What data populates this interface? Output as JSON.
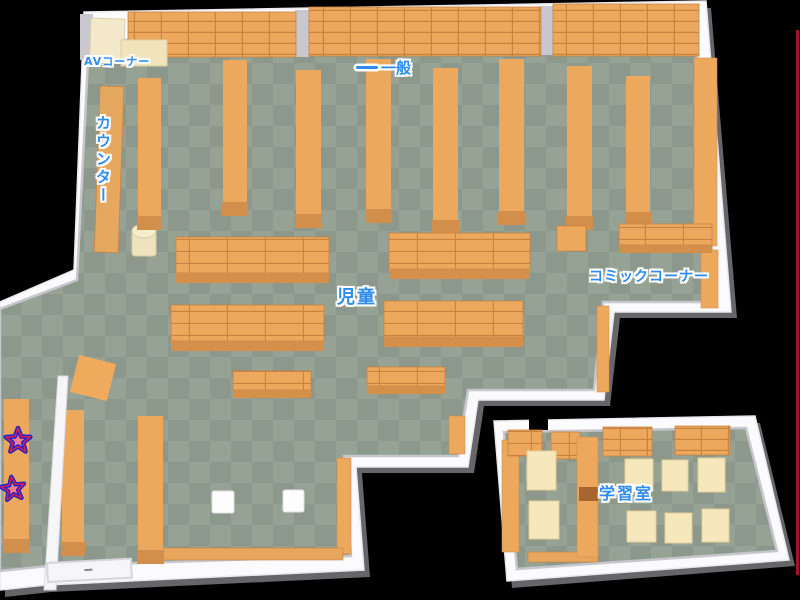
{
  "map": {
    "type": "library-floor-map",
    "areas": {
      "av_corner": "AVコーナー",
      "general": "一般",
      "counter": "カウンター",
      "children": "児童",
      "comic_corner": "コミックコーナー",
      "study_room": "学習室"
    },
    "markers": {
      "star_count": 2
    },
    "colors": {
      "background": "#000000",
      "floor_light": "#95A294",
      "floor_dark": "#8B988B",
      "wall": "#FBFBFD",
      "wall_shadow": "#C7C7CD",
      "shelf_orange": "#ECA95E",
      "shelf_line": "#C9823F",
      "shelf_front": "#D28E4B",
      "furniture_cream": "#F3E9CA",
      "table_cream": "#F6E8BC",
      "label_blue": "#2F8BEE",
      "star_fill": "#F5808C",
      "star_outline": "#2020CE",
      "edge_line": "#A01625"
    }
  }
}
